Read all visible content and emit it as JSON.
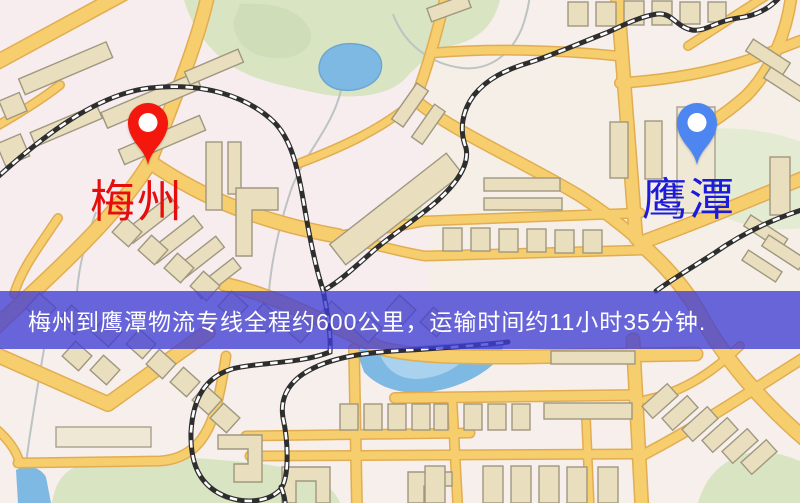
{
  "map": {
    "origin": {
      "label": "梅州"
    },
    "destination": {
      "label": "鹰潭"
    },
    "banner": {
      "text": "梅州到鹰潭物流专线全程约600公里，运输时间约11小时35分钟."
    },
    "route_info": {
      "distance_text": "约600公里",
      "duration_text": "约11小时35分钟"
    },
    "colors": {
      "origin_pin": "#f3170d",
      "origin_label": "#e60d0d",
      "destination_pin": "#4d86f0",
      "destination_label": "#1b1bd9",
      "banner_bg": "rgba(64,62,213,0.78)",
      "banner_text": "#ffffff",
      "road": "#f6ce6d",
      "road_border": "#e2ad52",
      "park": "#d9e4c2",
      "water": "#7db9e2",
      "railway": "#2e2e2e",
      "building": "#e9dfbe",
      "base": "#f6efec"
    }
  }
}
